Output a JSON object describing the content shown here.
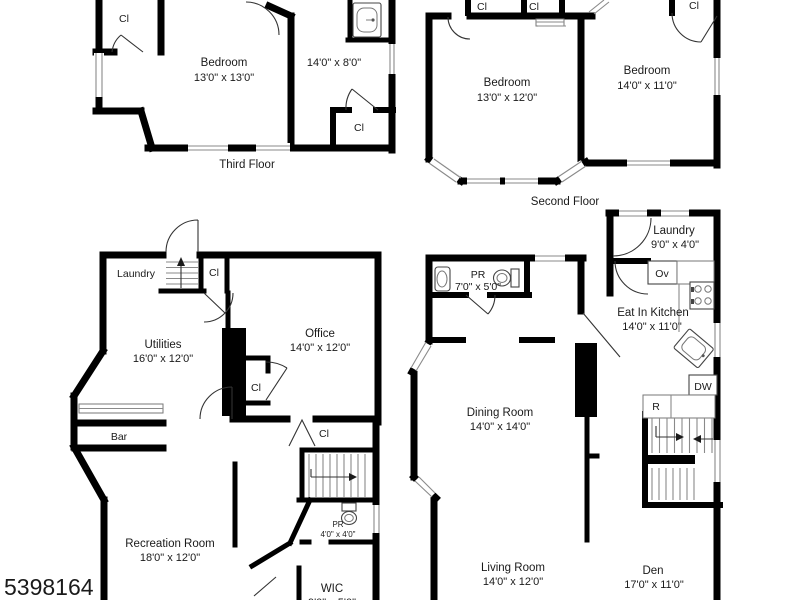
{
  "meta": {
    "photo_id": "5398164",
    "wall_color": "#000000",
    "background_color": "#ffffff",
    "detail_line_color": "#8a8a8a"
  },
  "floors": {
    "third": {
      "caption": "Third Floor",
      "bedroom": {
        "name": "Bedroom",
        "dims": "13'0\" x 13'0\""
      },
      "side_room": {
        "dims": "14'0\" x 8'0\""
      },
      "closet_top": "Cl",
      "closet_bottom": "Cl"
    },
    "second": {
      "caption": "Second Floor",
      "bedroom_left": {
        "name": "Bedroom",
        "dims": "13'0\" x 12'0\""
      },
      "bedroom_right": {
        "name": "Bedroom",
        "dims": "14'0\" x 11'0\""
      },
      "closet_a": "Cl",
      "closet_b": "Cl",
      "closet_c": "Cl"
    },
    "basement": {
      "laundry": "Laundry",
      "closet_stairs": "Cl",
      "utilities": {
        "name": "Utilities",
        "dims": "16'0\" x 12'0\""
      },
      "office": {
        "name": "Office",
        "dims": "14'0\" x 12'0\""
      },
      "closet_office": "Cl",
      "bar": "Bar",
      "closet_hall": "Cl",
      "recreation": {
        "name": "Recreation Room",
        "dims": "18'0\" x 12'0\""
      },
      "powder": {
        "name": "PR",
        "dims": "4'0\" x 4'0\""
      },
      "wic": {
        "name": "WIC",
        "dims": "9'0\" x 5'0\""
      }
    },
    "first": {
      "laundry": {
        "name": "Laundry",
        "dims": "9'0\" x 4'0\""
      },
      "powder": {
        "name": "PR",
        "dims": "7'0\" x 5'0\""
      },
      "kitchen": {
        "name": "Eat In Kitchen",
        "dims": "14'0\" x 11'0\""
      },
      "oven": "Ov",
      "dishwasher": "DW",
      "range": "R",
      "dining": {
        "name": "Dining Room",
        "dims": "14'0\" x 14'0\""
      },
      "living": {
        "name": "Living Room",
        "dims": "14'0\" x 12'0\""
      },
      "den": {
        "name": "Den",
        "dims": "17'0\" x 11'0\""
      }
    }
  }
}
